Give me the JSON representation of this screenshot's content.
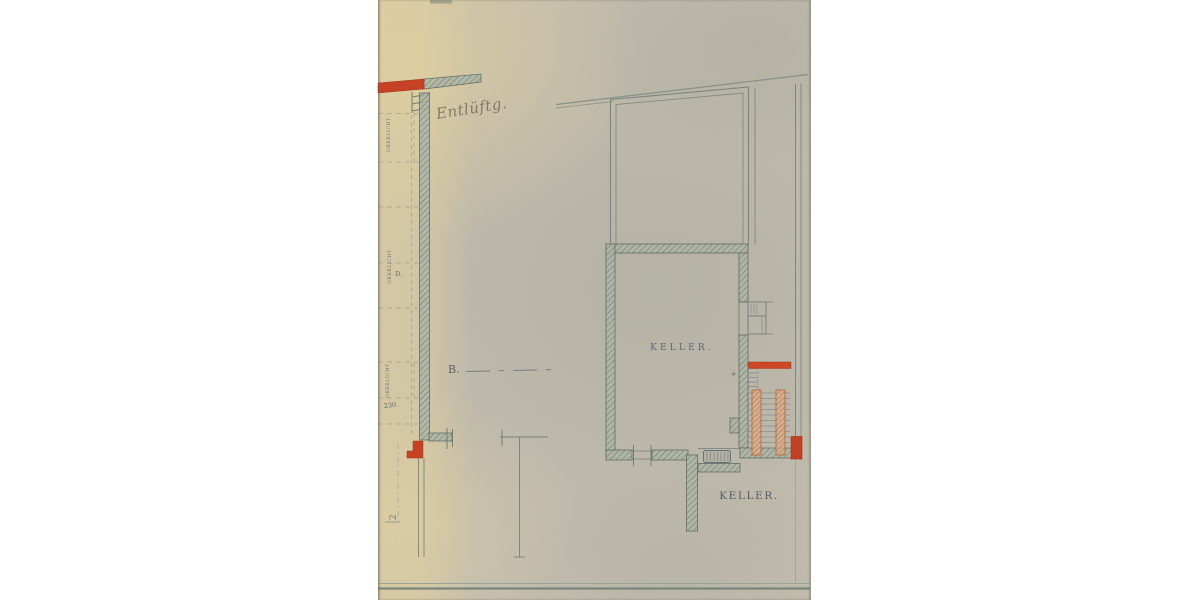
{
  "document": {
    "title": "Keller floor plan (scanned architectural drawing)",
    "labels": {
      "room": "KELLER.",
      "room_lower": "KELLER.",
      "section_mark": "B.",
      "dimension": "230",
      "window_label_1": "OBERLICHT",
      "window_label_2": "OBERLICHT",
      "window_label_3": "OBERLICHT",
      "door_mark": "D.",
      "handwritten_note": "Entlüftg.",
      "edge_mark": "2"
    },
    "colors": {
      "paper": "#c4beae",
      "paper_light": "#ddcda2",
      "ink_blue_grey": "#78847e",
      "wall_fill": "#aeb7a9",
      "accent_red": "#c8391b",
      "accent_orange": "#d28a5c",
      "label_ink": "#55606e",
      "pencil": "#6a6252"
    }
  }
}
